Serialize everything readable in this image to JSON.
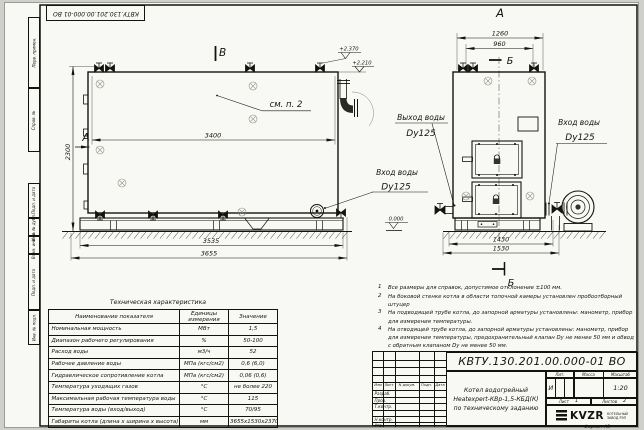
{
  "watermark": {
    "text": "kotlam-kv.kz"
  },
  "margins": {
    "top_stamp": "КВТУ.130.201.00.000-01 ВО",
    "left_stamps": [
      "Перв. примен.",
      "Справ. №",
      "Подп. и дата",
      "Инв. № дубл.",
      "Взам. инв. №",
      "Подп. и дата",
      "Инв. № подл."
    ],
    "format_note": "Формат А3"
  },
  "drawing": {
    "view_labels": {
      "view_b": "В",
      "view_a_arrow": "А",
      "view_a_title": "А",
      "section_b_top": "Б",
      "section_b_bottom": "Б",
      "see_note": "см. п. 2"
    },
    "dimensions": {
      "body_length": "3400",
      "height": "2300",
      "skid_length": "3535",
      "overall_length": "3655",
      "front_width": "1260",
      "front_top": "960",
      "front_skid": "1430",
      "front_overall": "1530"
    },
    "elevations": {
      "valve_top": "+2.370",
      "body_top": "+2.210",
      "ground": "0.000"
    },
    "ports": {
      "outlet": {
        "line1": "Выход воды",
        "line2": "Dy125"
      },
      "inlet_side": {
        "line1": "Вход воды",
        "line2": "Dy125"
      },
      "inlet_front": {
        "line1": "Вход воды",
        "line2": "Dy125"
      }
    }
  },
  "notes": [
    {
      "num": "1",
      "text": "Все размеры для справок, допустимое отклонение ±100 мм."
    },
    {
      "num": "2",
      "text": "На боковой стенке котла в области топочной камеры установлен пробоотборный штуцер"
    },
    {
      "num": "3",
      "text": "На подводящей трубе котла, до запорной арматуры установлены: манометр, прибор для измерения температуры."
    },
    {
      "num": "4",
      "text": "На отводящей трубе котла, до запорной арматуры установлены: манометр, прибор для измерения температуры, предохранительный клапан Dу не менее 50 мм и обвод с обратным клапаном Dу не менее 50 мм."
    }
  ],
  "spec_table": {
    "title": "Техническая характеристика",
    "headers": [
      "Наименование показателя",
      "Единицы измерения",
      "Значение"
    ],
    "rows": [
      [
        "Номинальная мощность",
        "МВт",
        "1,5"
      ],
      [
        "Диапазон рабочего регулирования",
        "%",
        "50-100"
      ],
      [
        "Расход воды",
        "м3/ч",
        "52"
      ],
      [
        "Рабочее давление воды",
        "МПа (кгс/см2)",
        "0,6 (6,0)"
      ],
      [
        "Гидравлическое сопротивление котла",
        "МПа (кгс/см2)",
        "0,06 (0,6)"
      ],
      [
        "Температура уходящих газов",
        "°С",
        "не более 220"
      ],
      [
        "Максимальная рабочая температура воды",
        "°С",
        "115"
      ],
      [
        "Температура воды (вход/выход)",
        "°С",
        "70/95"
      ],
      [
        "Габариты котла (длина х ширина х высота)",
        "мм",
        "3655х1530х2370"
      ]
    ]
  },
  "title_block": {
    "doc_number": "КВТУ.130.201.00.000-01 ВО",
    "product_name_lines": [
      "Котел водогрейный",
      "Heatexpert-КВр-1,5-КБД(К)",
      "по техническому заданию"
    ],
    "lit_header": "Лит.",
    "mass_header": "Масса",
    "scale_header": "Масштаб",
    "lit_value": "И",
    "scale_value": "1:20",
    "sheet_label": "Лист",
    "sheet_value": "1",
    "sheets_label": "Листов",
    "sheets_value": "2",
    "header_cells": [
      "Изм",
      "Лист",
      "N докум.",
      "Подп.",
      "Дата"
    ],
    "sign_rows": [
      "Разраб.",
      "Пров.",
      "Т.контр.",
      "",
      "Н.контр.",
      "Утв."
    ],
    "company": {
      "logo": "KVZR",
      "line1": "КОТЕЛЬНЫЙ",
      "line2": "ЗАВОД РЭП"
    }
  }
}
